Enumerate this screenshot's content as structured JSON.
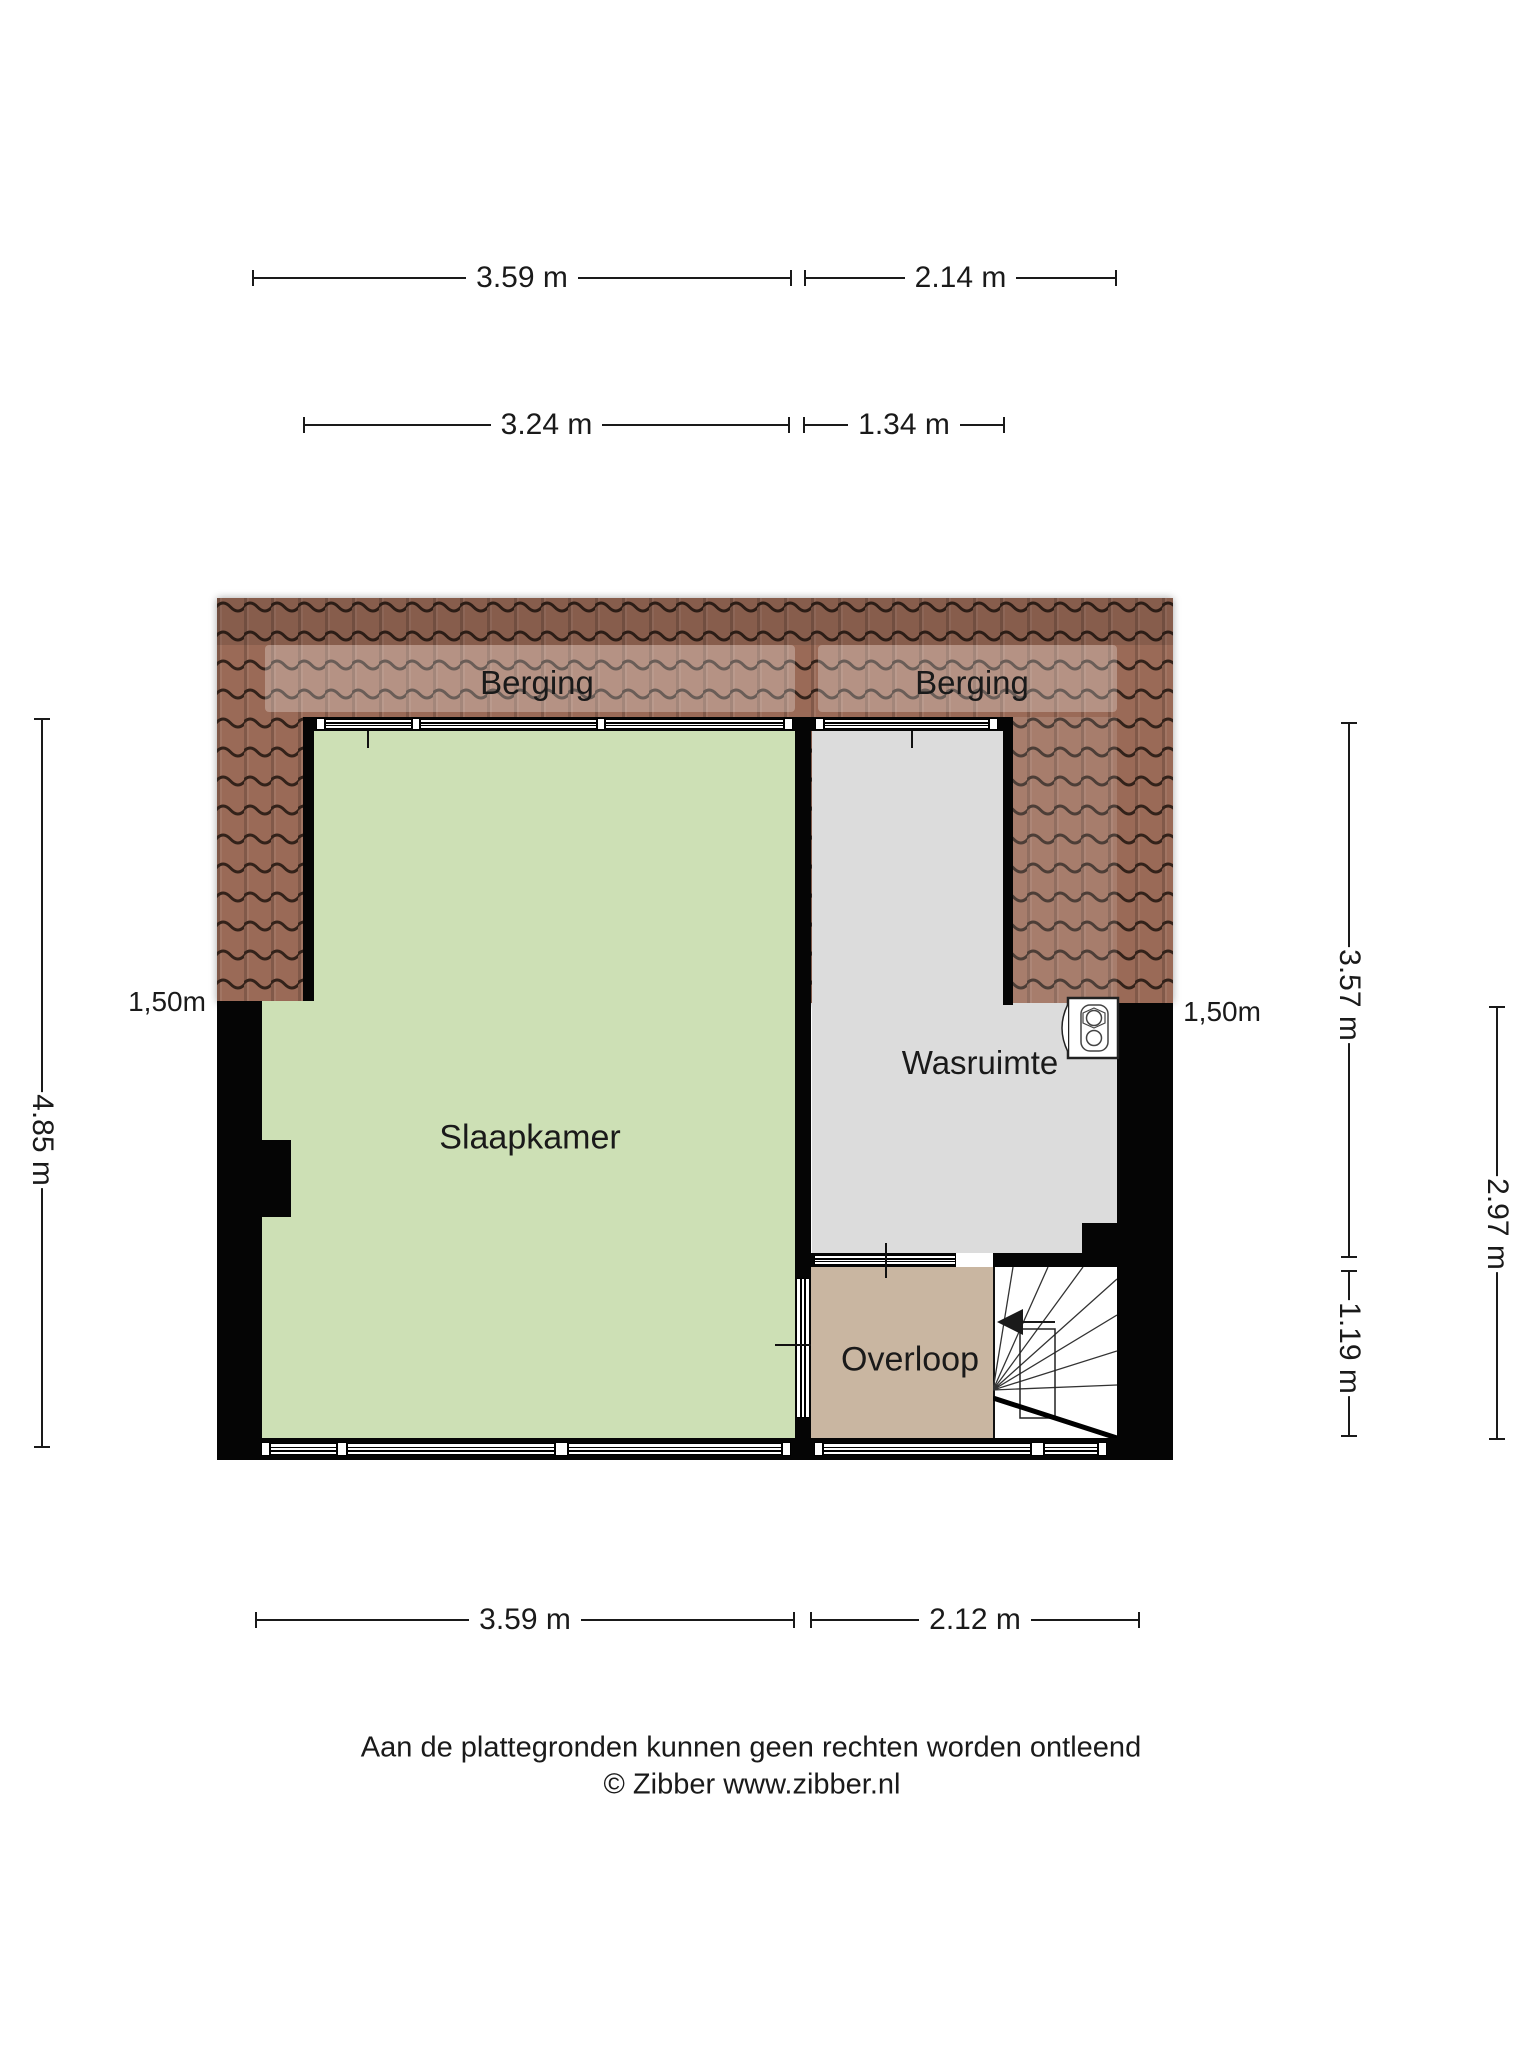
{
  "title": "Floor plan (attic storey)",
  "dimensions": {
    "top_row1": [
      {
        "label": "3.59 m"
      },
      {
        "label": "2.14 m"
      }
    ],
    "top_row2": [
      {
        "label": "3.24 m"
      },
      {
        "label": "1.34 m"
      }
    ],
    "bottom": [
      {
        "label": "3.59 m"
      },
      {
        "label": "2.12 m"
      }
    ],
    "left": [
      {
        "label": "4.85 m"
      }
    ],
    "right": [
      {
        "label": "3.57 m"
      },
      {
        "label": "1.19 m"
      },
      {
        "label": "2.97 m"
      }
    ],
    "knee_left": {
      "label": "1,50m"
    },
    "knee_right": {
      "label": "1,50m"
    }
  },
  "rooms": {
    "berging_left": {
      "label": "Berging"
    },
    "berging_right": {
      "label": "Berging"
    },
    "slaapkamer": {
      "label": "Slaapkamer"
    },
    "wasruimte": {
      "label": "Wasruimte"
    },
    "overloop": {
      "label": "Overloop"
    }
  },
  "icons": {
    "washer": "washing-machine",
    "stairs": "staircase-with-direction-arrow"
  },
  "footer": {
    "disclaimer": "Aan de plattegronden kunnen geen rechten worden ontleend",
    "copyright": "© Zibber www.zibber.nl"
  },
  "colors": {
    "roof_base": "#9a6a57",
    "roof_line": "#33221a",
    "floor_green": "#cde0b5",
    "floor_grey": "#dcdcdc",
    "floor_tan": "#c9b6a1",
    "wall": "#050505",
    "dim": "#1a1a1a"
  }
}
